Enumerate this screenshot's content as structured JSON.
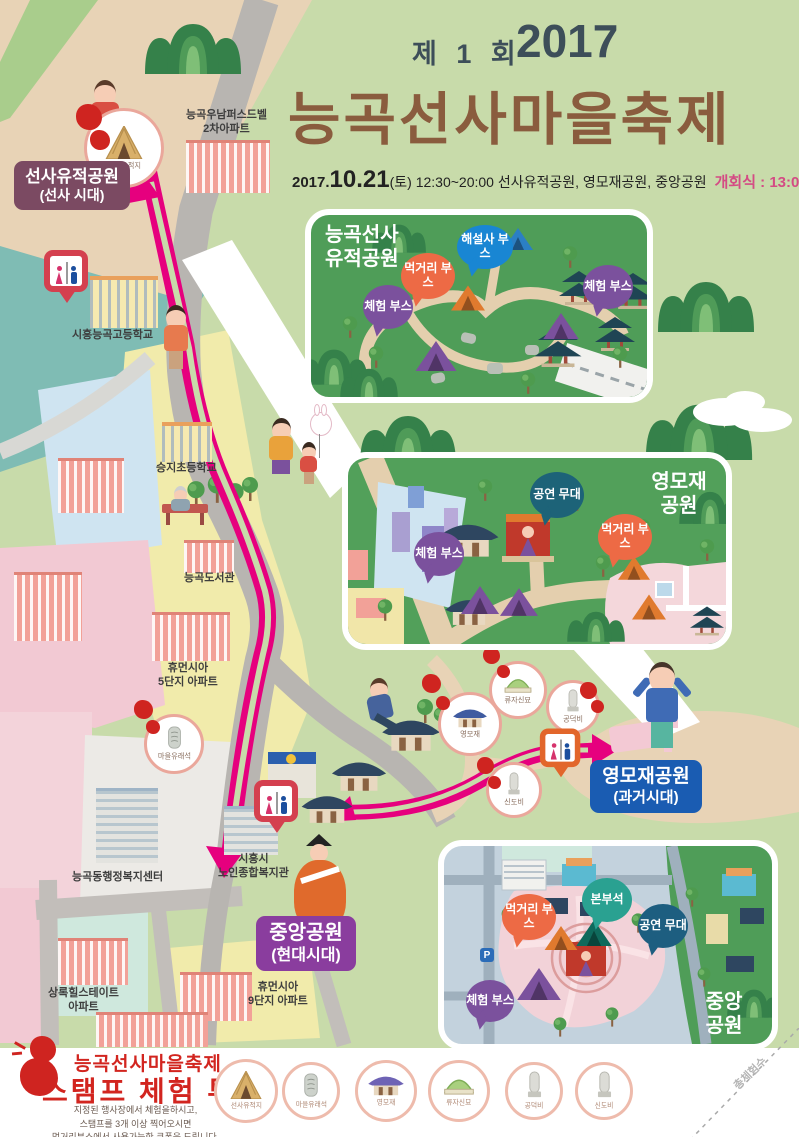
{
  "header": {
    "edition": "제 1 회",
    "year": "2017",
    "title": "능곡선사마을축제",
    "schedule_prefix": "2017.",
    "schedule_day": "10.21",
    "schedule_rest": "(토) 12:30~20:00 선사유적공원, 영모재공원, 중앙공원",
    "opening": "개회식 : 13:00(중앙공원)"
  },
  "badges": {
    "prehistoric": {
      "name": "선사유적공원",
      "era": "(선사 시대)",
      "color": "#7b4a62"
    },
    "yeongmojae": {
      "name": "영모재공원",
      "era": "(과거시대)",
      "color": "#1a5cb2"
    },
    "central": {
      "name": "중앙공원",
      "era": "(현대시대)",
      "color": "#8a3d9e"
    }
  },
  "map_labels": {
    "apt_unam": {
      "line1": "능곡우남퍼스드벨",
      "line2": "2차아파트"
    },
    "highschool": "시흥능곡고등학교",
    "elementary": "승지초등학교",
    "library": "능곡도서관",
    "apt_human5": {
      "line1": "휴먼시아",
      "line2": "5단지 아파트"
    },
    "community_center": "능곡동행정복지센터",
    "senior_center": {
      "line1": "시흥시",
      "line2": "노인종합복지관"
    },
    "apt_hillstate": {
      "line1": "상록힐스테이트",
      "line2": "아파트"
    },
    "apt_human9": {
      "line1": "휴먼시아",
      "line2": "9단지 아파트"
    }
  },
  "stamp_spots": {
    "prehistoric_site": "선사유적지",
    "village_stone": "마을유래석",
    "yeongmojae": "영모재",
    "ryujasin_tomb": "류자신묘",
    "gongdeokbi": "공덕비",
    "sindobi": "신도비"
  },
  "insets": {
    "neunggok": {
      "title1": "능곡선사",
      "title2": "유적공원",
      "bubble_guide": "해설사 부스",
      "bubble_food": "먹거리 부스",
      "bubble_exp1": "체험 부스",
      "bubble_exp2": "체험 부스"
    },
    "yeongmojae": {
      "title1": "영모재",
      "title2": "공원",
      "bubble_stage": "공연 무대",
      "bubble_exp": "체험 부스",
      "bubble_food": "먹거리 부스"
    },
    "central": {
      "title1": "중앙",
      "title2": "공원",
      "bubble_hq": "본부석",
      "bubble_food": "먹거리 부스",
      "bubble_stage": "공연 무대",
      "bubble_exp": "체험 부스",
      "parking": "P"
    }
  },
  "tour": {
    "title1": "능곡선사마을축제",
    "title2": "스탬프 체험 투어",
    "desc1": "지정된 행사장에서 체험을하시고,",
    "desc2": "스탬프를 3개 이상 찍어오시면",
    "desc3": "먹거리부스에서 사용가능한 쿠폰을 드립니다.",
    "desc4": "(지도의 스탬프모양의 위치를 참고하세요)",
    "stamps": [
      {
        "label": "선사유적지"
      },
      {
        "label": "마을유래석"
      },
      {
        "label": "영모재"
      },
      {
        "label": "류자신묘"
      },
      {
        "label": "공덕비"
      },
      {
        "label": "신도비"
      }
    ],
    "total_note": "총체험수"
  },
  "colors": {
    "poster_bg": "#c8dbaa",
    "route": "#e6007e",
    "road": "#b8b5b1",
    "inset_green": "#4f9d58",
    "stamp_red": "#cf2420",
    "bubble_blue": "#1986d3",
    "bubble_orange": "#ed6a45",
    "bubble_purple": "#7b519d",
    "bubble_teal": "#2aa191",
    "bubble_darkteal": "#1d6378",
    "title_brown": "#8a5c3e"
  }
}
